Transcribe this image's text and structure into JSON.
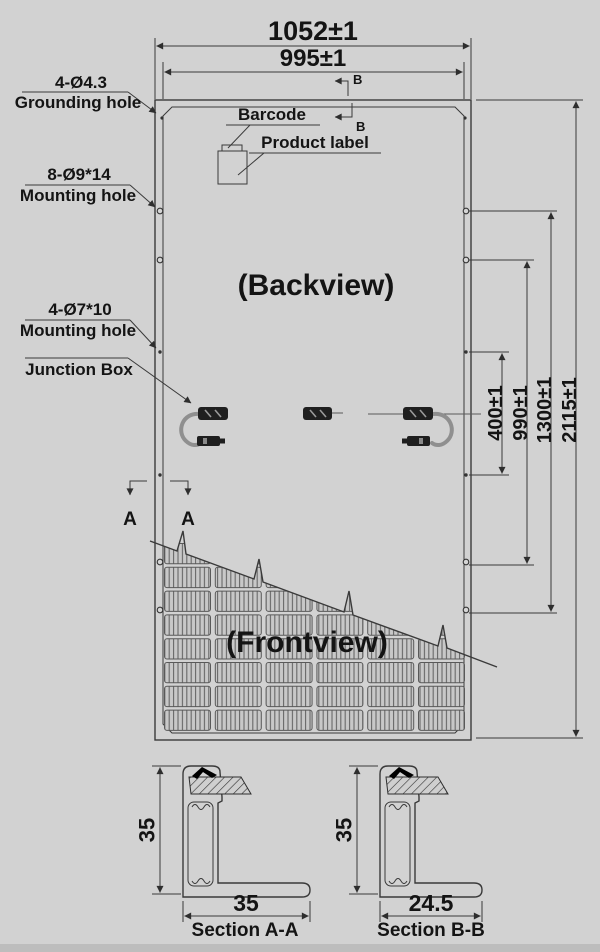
{
  "colors": {
    "background": "#d2d2d2",
    "line": "#3a3a3a",
    "text": "#141414",
    "junction_box_fill": "#1f1f1f",
    "cable": "#8f8f8f"
  },
  "drawing": {
    "top_dimensions": {
      "overall_width": "1052±1",
      "inner_width": "995±1"
    },
    "side_dimensions": {
      "d400": "400±1",
      "d990": "990±1",
      "d1300": "1300±1",
      "d2115": "2115±1"
    },
    "callouts": {
      "grounding_hole": {
        "spec": "4-Ø4.3",
        "label": "Grounding hole"
      },
      "mounting_hole_8": {
        "spec": "8-Ø9*14",
        "label": "Mounting hole"
      },
      "mounting_hole_4": {
        "spec": "4-Ø7*10",
        "label": "Mounting hole"
      },
      "junction_box": {
        "label": "Junction Box"
      },
      "barcode": {
        "label": "Barcode"
      },
      "product_label": {
        "label": "Product label"
      }
    },
    "views": {
      "back_label": "(Backview)",
      "front_label": "(Frontview)"
    },
    "section_markers": {
      "a": "A",
      "b": "B"
    },
    "sections": {
      "aa": {
        "title": "Section A-A",
        "frame_height": "35",
        "flange_width": "35"
      },
      "bb": {
        "title": "Section B-B",
        "frame_height": "35",
        "flange_width": "24.5"
      }
    }
  }
}
